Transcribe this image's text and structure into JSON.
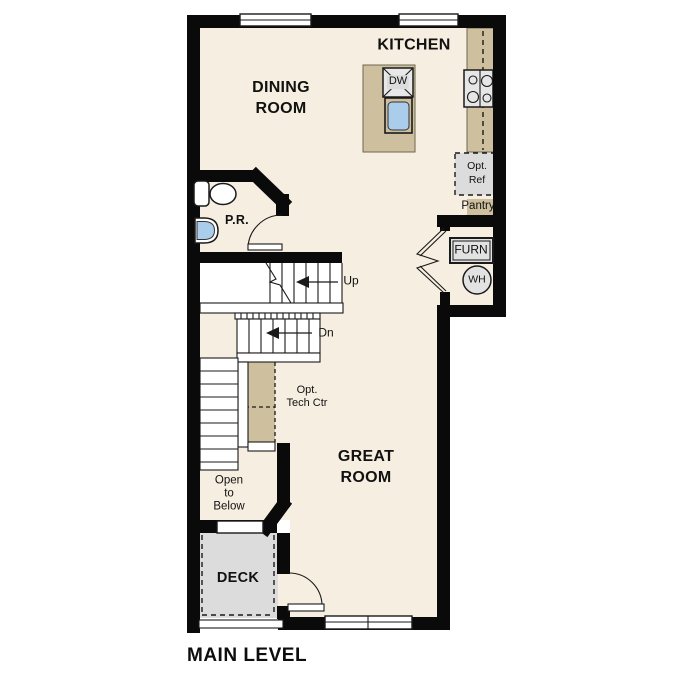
{
  "plan": {
    "title": "MAIN LEVEL",
    "rooms": {
      "kitchen": "KITCHEN",
      "dining": "DINING\nROOM",
      "great": "GREAT\nROOM",
      "powder": "P.R.",
      "deck": "DECK",
      "open_below": "Open\nto\nBelow"
    },
    "annotations": {
      "up": "Up",
      "dn": "Dn",
      "dw": "DW",
      "opt_ref": "Opt.\nRef",
      "pantry": "Pantry",
      "furn": "FURN",
      "wh": "WH",
      "tech_center": "Opt.\nTech Ctr"
    },
    "colors": {
      "floor": "#f6eee0",
      "counter": "#cec09e",
      "fixture": "#dcdcdc",
      "sink_blue": "#a9cdeb",
      "wall": "#0a0a0a",
      "outline": "#1a1a1a"
    }
  }
}
